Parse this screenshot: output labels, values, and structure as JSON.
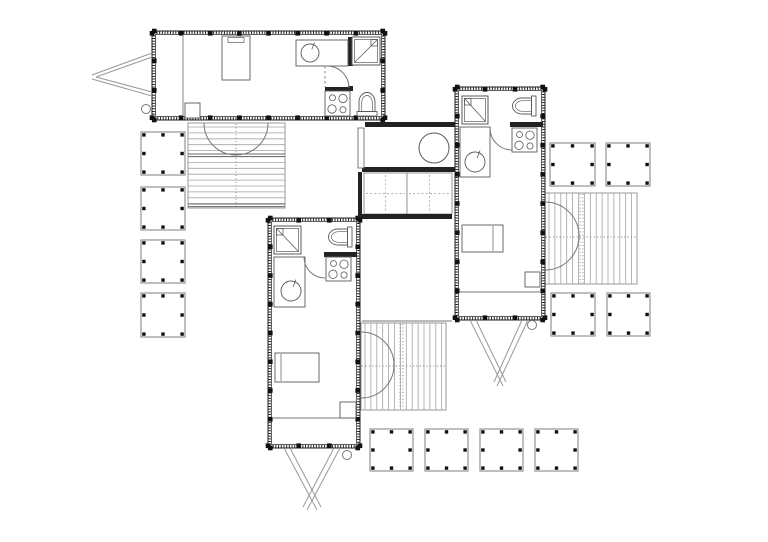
{
  "floor_plan": {
    "canvas": {
      "width": 768,
      "height": 542,
      "background": "#ffffff"
    },
    "colors": {
      "wall": "#1c1c1c",
      "fixture": "#5a5a5a",
      "plank": "#a3a3a3",
      "deck_edge": "#9a9a9a",
      "pad_edge": "#8a8a8a",
      "tick": "#111111",
      "door": "#777777"
    },
    "units": [
      {
        "name": "unit-top",
        "x": 152,
        "y": 31,
        "w": 233,
        "h": 89
      },
      {
        "name": "unit-right",
        "x": 455,
        "y": 87,
        "w": 90,
        "h": 233
      },
      {
        "name": "unit-bottom-left",
        "x": 268,
        "y": 218,
        "w": 92,
        "h": 230
      }
    ],
    "pads": [
      {
        "x": 141,
        "y": 132,
        "w": 44,
        "h": 43
      },
      {
        "x": 141,
        "y": 187,
        "w": 44,
        "h": 43
      },
      {
        "x": 141,
        "y": 240,
        "w": 44,
        "h": 43
      },
      {
        "x": 141,
        "y": 293,
        "w": 44,
        "h": 44
      },
      {
        "x": 550,
        "y": 143,
        "w": 45,
        "h": 43
      },
      {
        "x": 606,
        "y": 143,
        "w": 44,
        "h": 43
      },
      {
        "x": 551,
        "y": 293,
        "w": 44,
        "h": 43
      },
      {
        "x": 607,
        "y": 293,
        "w": 43,
        "h": 43
      },
      {
        "x": 370,
        "y": 429,
        "w": 43,
        "h": 42
      },
      {
        "x": 425,
        "y": 429,
        "w": 43,
        "h": 42
      },
      {
        "x": 480,
        "y": 429,
        "w": 43,
        "h": 42
      },
      {
        "x": 535,
        "y": 429,
        "w": 43,
        "h": 42
      }
    ],
    "decks": [
      {
        "name": "deck-top",
        "x": 188,
        "y": 123,
        "w": 97,
        "h": 85,
        "dir": "h",
        "bandsH": [
          154,
          204
        ],
        "dotsV": [
          236
        ],
        "dotsH": []
      },
      {
        "name": "deck-right",
        "x": 545,
        "y": 193,
        "w": 92,
        "h": 91,
        "dir": "v",
        "bandsH": [],
        "dotsV": [
          580,
          583
        ],
        "dotsH": [
          237
        ]
      },
      {
        "name": "deck-middle",
        "x": 361,
        "y": 323,
        "w": 85,
        "h": 87,
        "dir": "v",
        "bandsH": [],
        "dotsV": [
          400,
          403
        ],
        "dotsH": [
          366
        ]
      }
    ],
    "interior_walls": [
      {
        "x": 348,
        "y": 37,
        "w": 5,
        "h": 29
      },
      {
        "x": 325,
        "y": 87,
        "w": 28,
        "h": 4
      },
      {
        "x": 348,
        "y": 86,
        "w": 5,
        "h": 5
      },
      {
        "x": 510,
        "y": 122,
        "w": 33,
        "h": 5
      },
      {
        "x": 324,
        "y": 252,
        "w": 33,
        "h": 5
      },
      {
        "x": 365,
        "y": 122,
        "w": 90,
        "h": 5
      },
      {
        "x": 362,
        "y": 167,
        "w": 93,
        "h": 5
      },
      {
        "x": 362,
        "y": 214,
        "w": 90,
        "h": 5
      },
      {
        "x": 358,
        "y": 172,
        "w": 4,
        "h": 46
      }
    ],
    "panels": [
      {
        "x": 364,
        "y": 173,
        "w": 43,
        "h": 41
      },
      {
        "x": 407,
        "y": 173,
        "w": 45,
        "h": 41
      }
    ],
    "thin_rects": [
      {
        "x": 358,
        "y": 128,
        "w": 6,
        "h": 40
      }
    ],
    "thin_lines": [
      {
        "x1": 183,
        "y1": 35,
        "x2": 183,
        "y2": 116
      },
      {
        "x1": 459,
        "y1": 292,
        "x2": 541,
        "y2": 292
      },
      {
        "x1": 272,
        "y1": 418,
        "x2": 356,
        "y2": 418
      },
      {
        "x1": 362,
        "y1": 321,
        "x2": 452,
        "y2": 321
      }
    ],
    "dashed_lines": [
      {
        "x1": 325,
        "y1": 66,
        "x2": 325,
        "y2": 87
      }
    ],
    "door_arcs": [
      {
        "name": "bath-door-top-unit",
        "d": "M327,66 A22 22 0 0 1 349,88"
      },
      {
        "name": "bath-door-right-unit",
        "d": "M490,128 A22 22 0 0 0 512,150"
      },
      {
        "name": "bath-door-bottom-unit",
        "d": "M304,257 A21 21 0 0 0 325,278"
      },
      {
        "name": "french-doors-top-deck",
        "d": "M204,123 A32 32 0 0 0 268,123"
      },
      {
        "name": "french-doors-right-deck",
        "d": "M545,202 A34 34 0 0 1 545,270"
      },
      {
        "name": "french-doors-middle-deck",
        "d": "M361,332 A33 33 0 0 1 361,398"
      }
    ],
    "fixtures": [
      {
        "t": "bed",
        "name": "bed-top-unit",
        "x": 222,
        "y": 36,
        "w": 28,
        "h": 44,
        "head": "top"
      },
      {
        "t": "counter",
        "name": "kitchen-counter-top-unit",
        "x": 296,
        "y": 40,
        "w": 52,
        "h": 26,
        "sink": [
          310,
          53,
          9
        ]
      },
      {
        "t": "shower",
        "name": "shower-top-unit",
        "x": 352,
        "y": 37,
        "w": 28,
        "h": 28,
        "head": "tr"
      },
      {
        "t": "stove",
        "name": "stove-top-unit",
        "x": 325,
        "y": 91,
        "w": 25,
        "h": 25
      },
      {
        "t": "toilet",
        "name": "toilet-top-unit",
        "cx": 367,
        "cy": 104,
        "rot": 0
      },
      {
        "t": "sq",
        "name": "storage-box-top-unit",
        "x": 185,
        "y": 103,
        "w": 15,
        "h": 15
      },
      {
        "t": "shower",
        "name": "shower-right-unit",
        "x": 462,
        "y": 96,
        "w": 26,
        "h": 28,
        "head": "tl"
      },
      {
        "t": "toilet",
        "name": "toilet-right-unit",
        "cx": 524,
        "cy": 106,
        "rot": -90
      },
      {
        "t": "stove",
        "name": "stove-right-unit",
        "x": 512,
        "y": 128,
        "w": 25,
        "h": 24
      },
      {
        "t": "counter",
        "name": "kitchen-counter-right-unit",
        "x": 460,
        "y": 127,
        "w": 30,
        "h": 50,
        "sink": [
          475,
          162,
          10
        ]
      },
      {
        "t": "bed",
        "name": "bed-right-unit",
        "x": 462,
        "y": 225,
        "w": 41,
        "h": 27,
        "head": "right"
      },
      {
        "t": "sq",
        "name": "storage-box-right-unit",
        "x": 525,
        "y": 272,
        "w": 15,
        "h": 15
      },
      {
        "t": "shower",
        "name": "shower-bottom-unit",
        "x": 274,
        "y": 226,
        "w": 27,
        "h": 28,
        "head": "tl"
      },
      {
        "t": "toilet",
        "name": "toilet-bottom-unit",
        "cx": 340,
        "cy": 237,
        "rot": -90
      },
      {
        "t": "stove",
        "name": "stove-bottom-unit",
        "x": 326,
        "y": 257,
        "w": 25,
        "h": 24
      },
      {
        "t": "counter",
        "name": "kitchen-counter-bottom-unit",
        "x": 274,
        "y": 257,
        "w": 31,
        "h": 50,
        "sink": [
          291,
          291,
          10
        ]
      },
      {
        "t": "bed",
        "name": "bed-bottom-unit",
        "x": 275,
        "y": 353,
        "w": 44,
        "h": 29,
        "head": "left"
      },
      {
        "t": "sq",
        "name": "storage-box-bottom-unit",
        "x": 340,
        "y": 402,
        "w": 16,
        "h": 16
      },
      {
        "t": "circle",
        "name": "round-table-link",
        "cx": 434,
        "cy": 148,
        "r": 15
      }
    ],
    "hitches": [
      {
        "name": "trailer-hitch-left",
        "lines": [
          [
            152,
            53,
            92,
            75
          ],
          [
            152,
            57,
            96,
            77
          ],
          [
            152,
            96,
            92,
            79
          ],
          [
            152,
            92,
            96,
            77
          ]
        ],
        "wheel": [
          146,
          109,
          4.5
        ]
      },
      {
        "name": "trailer-hitch-right-unit",
        "lines": [
          [
            470,
            320,
            503,
            386
          ],
          [
            476,
            320,
            506,
            382
          ],
          [
            528,
            320,
            497,
            386
          ],
          [
            522,
            320,
            494,
            382
          ]
        ],
        "wheel": [
          532,
          325,
          4.5
        ]
      },
      {
        "name": "trailer-hitch-bottom-unit",
        "lines": [
          [
            284,
            448,
            317,
            510
          ],
          [
            290,
            448,
            321,
            507
          ],
          [
            340,
            448,
            307,
            510
          ],
          [
            334,
            448,
            303,
            507
          ]
        ],
        "wheel": [
          347,
          455,
          4.5
        ]
      }
    ]
  }
}
